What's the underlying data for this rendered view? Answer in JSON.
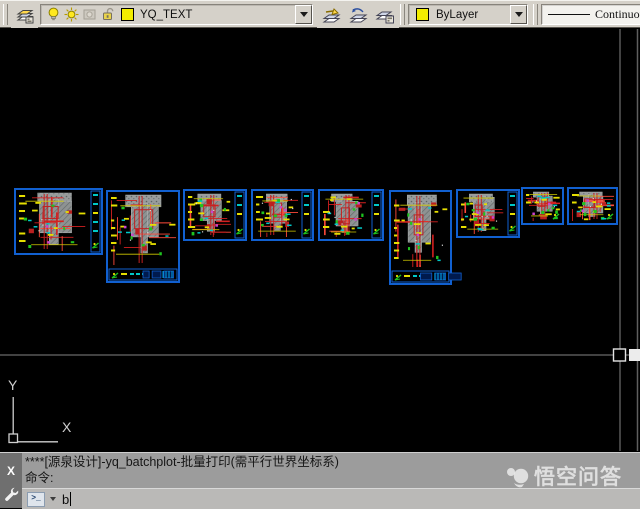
{
  "toolbar": {
    "layer_manager_button": {
      "icon": "layer-properties-manager-icon"
    },
    "layer_combo": {
      "value": "YQ_TEXT",
      "swatch_color": "#f2ed00",
      "state_icons": [
        "bulb-on-icon",
        "sun-icon",
        "viewport-freeze-icon",
        "unlock-icon",
        "layer-color-swatch"
      ]
    },
    "layer_tool_buttons": [
      {
        "icon": "make-object-layer-current-icon"
      },
      {
        "icon": "layer-previous-icon"
      },
      {
        "icon": "layer-states-icon"
      }
    ],
    "color_combo": {
      "value": "ByLayer",
      "swatch_color": "#f2ed00"
    },
    "linetype_combo": {
      "value": "Continuous"
    }
  },
  "canvas": {
    "background": "#000000",
    "frame_border_color": "#1160d0",
    "crosshair": {
      "x": 620,
      "y": 355
    },
    "ucs": {
      "x_label": "X",
      "y_label": "Y"
    },
    "frames": [
      {
        "x": 14,
        "y": 188,
        "w": 89,
        "h": 67,
        "strip": "right",
        "seed": 11
      },
      {
        "x": 106,
        "y": 190,
        "w": 74,
        "h": 93,
        "strip": "bottom",
        "seed": 22
      },
      {
        "x": 183,
        "y": 189,
        "w": 64,
        "h": 52,
        "strip": "right",
        "seed": 33
      },
      {
        "x": 251,
        "y": 189,
        "w": 63,
        "h": 52,
        "strip": "right",
        "seed": 44
      },
      {
        "x": 318,
        "y": 189,
        "w": 66,
        "h": 52,
        "strip": "right",
        "seed": 55
      },
      {
        "x": 389,
        "y": 190,
        "w": 63,
        "h": 95,
        "strip": "bottom",
        "seed": 66
      },
      {
        "x": 456,
        "y": 189,
        "w": 64,
        "h": 49,
        "strip": "right",
        "seed": 77
      },
      {
        "x": 521,
        "y": 187,
        "w": 43,
        "h": 38,
        "strip": "none",
        "seed": 88
      },
      {
        "x": 567,
        "y": 187,
        "w": 51,
        "h": 38,
        "strip": "none",
        "seed": 99
      }
    ]
  },
  "command_window": {
    "history_lines": [
      "****[源泉设计]-yq_batchplot-批量打印(需平行世界坐标系)",
      "命令:"
    ],
    "prompt_icon": ">_",
    "input_value": "b",
    "close_label": "X"
  },
  "watermark": {
    "text": "悟空问答"
  }
}
